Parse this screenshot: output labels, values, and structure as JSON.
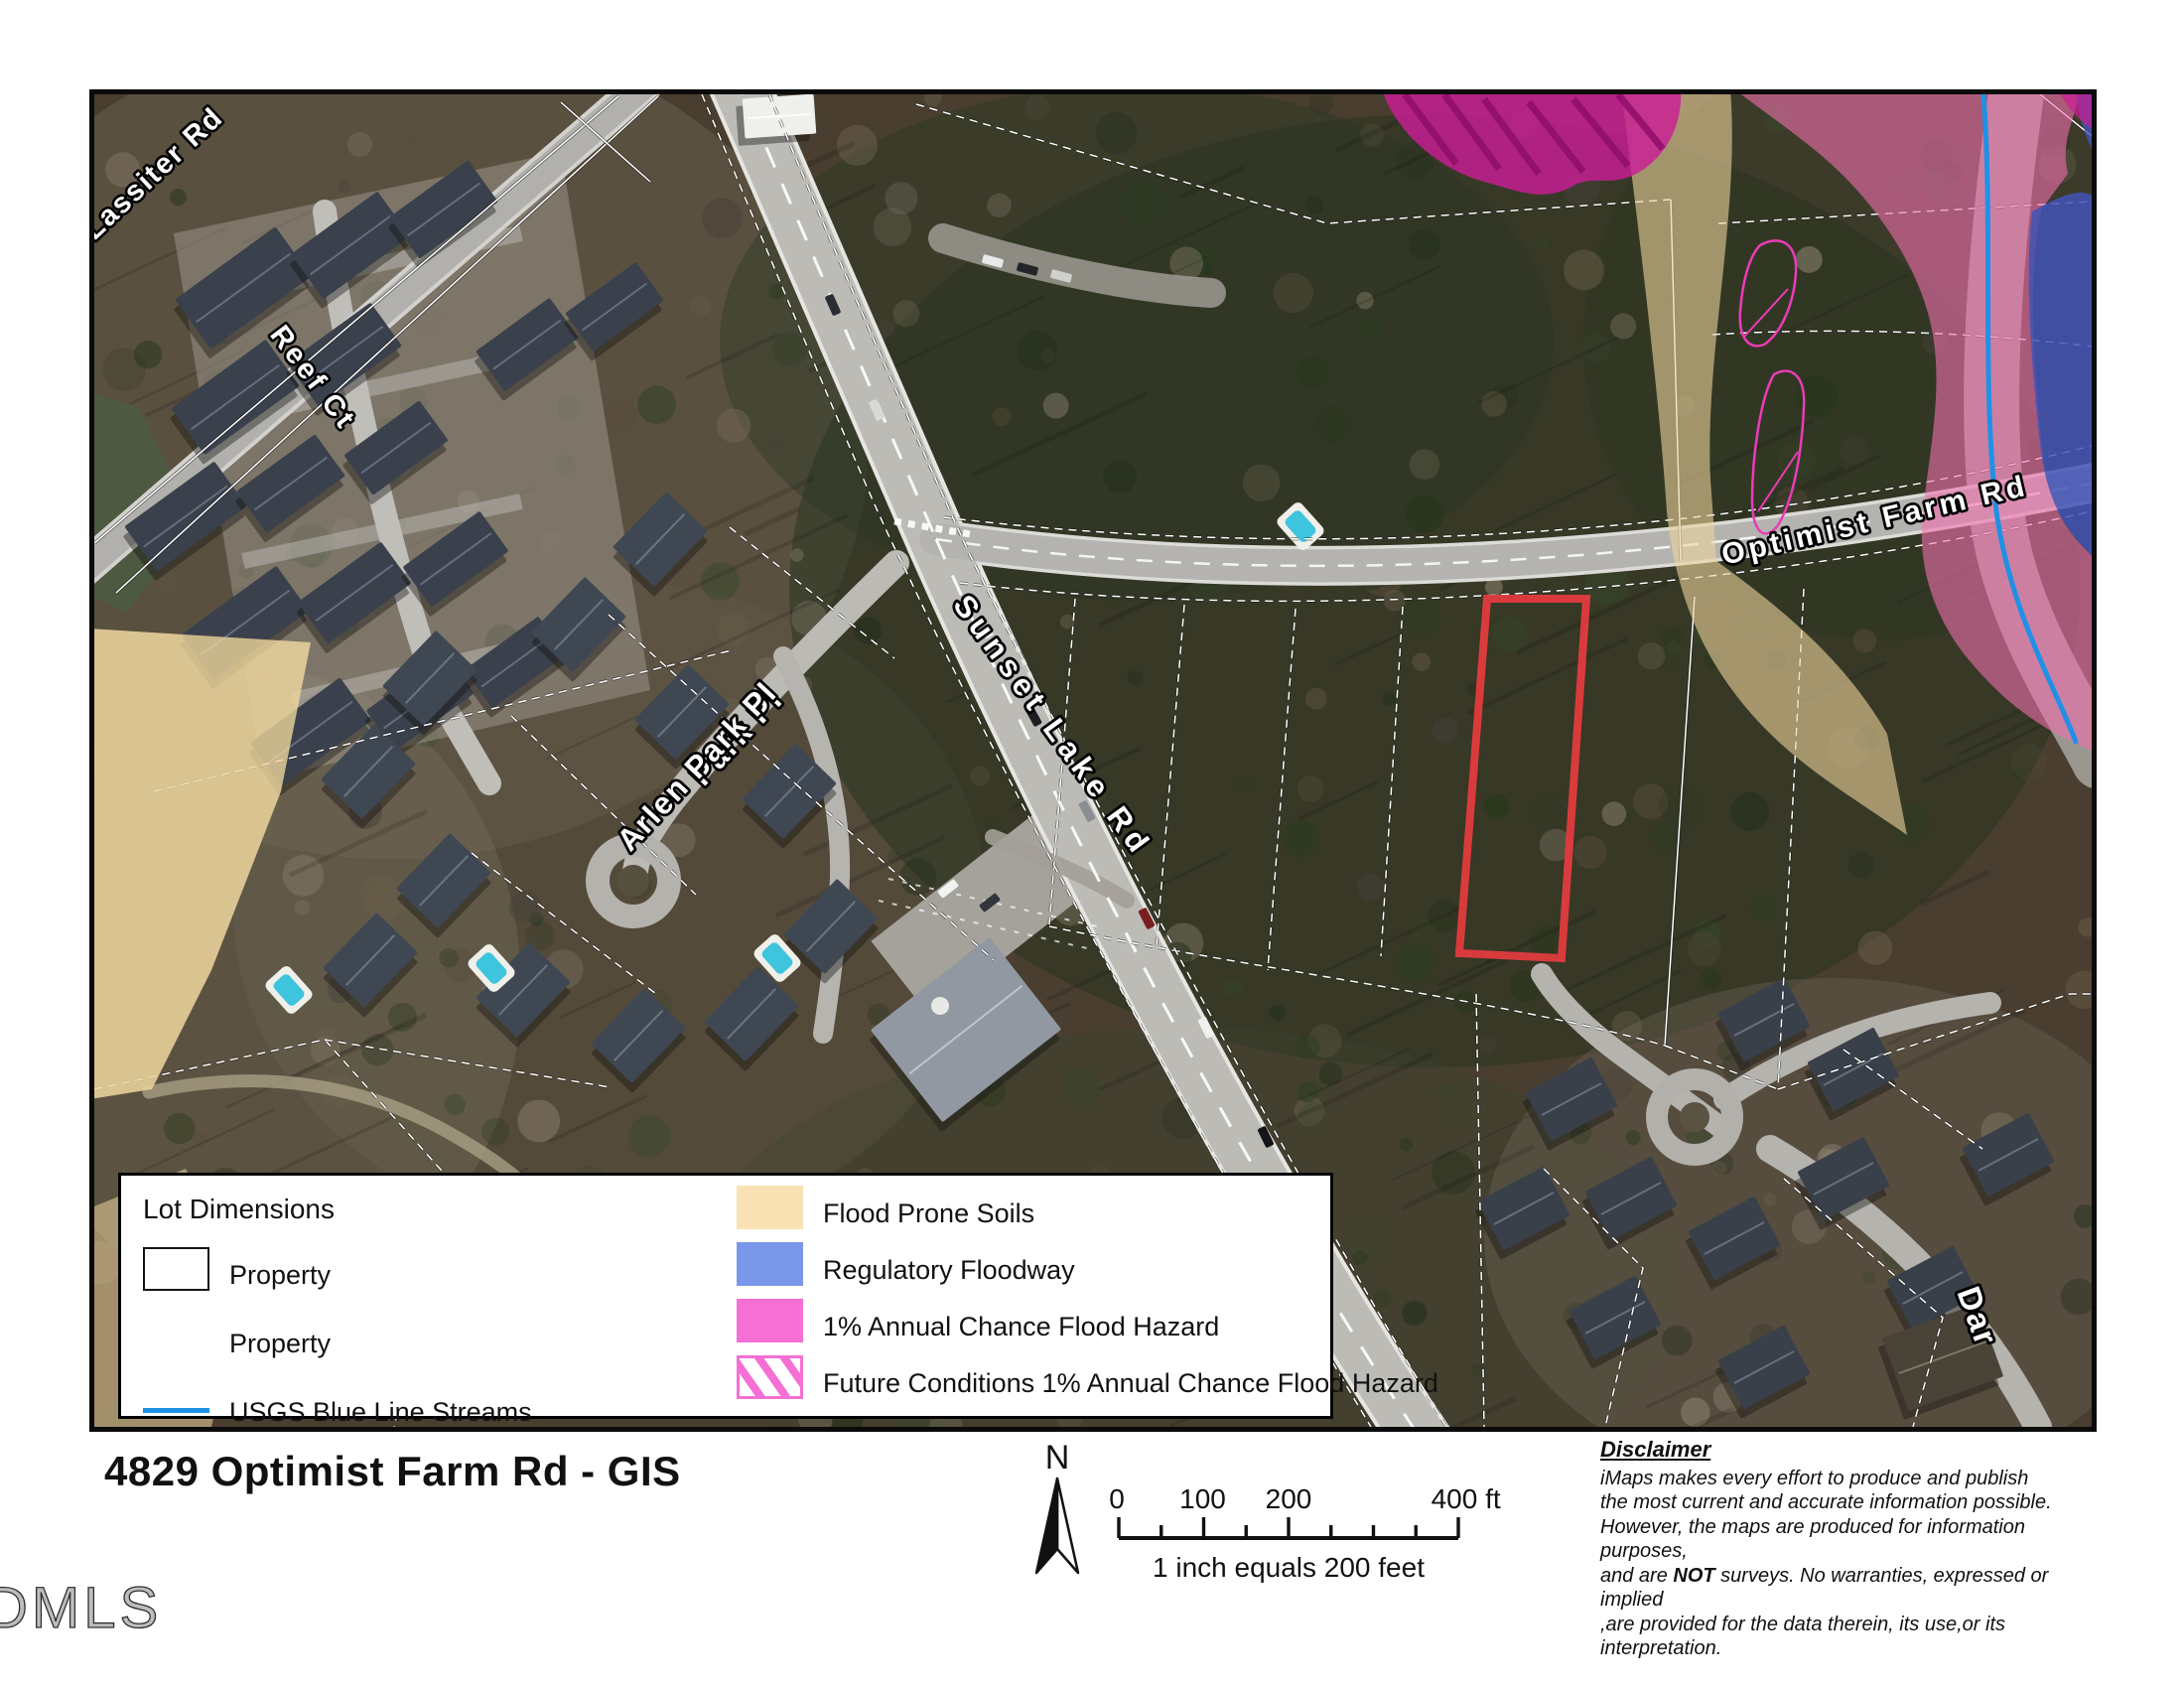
{
  "map": {
    "road_labels": [
      "Lassiter Rd",
      "Reef Ct",
      "Park Pl",
      "Arlen Park Pl",
      "Sunset Lake Rd",
      "Optimist Farm Rd",
      "Dar"
    ],
    "highlight_parcel_color": "#e23b3e",
    "stream_color": "#1f90e6",
    "overlay_colors": {
      "flood_prone_soils": "#edd49c",
      "regulatory_floodway": "#4254b8",
      "annual_chance_flood": "#f06fae",
      "future_conditions": "#cb1d96",
      "future_conditions_outline": "#ea3cb8"
    }
  },
  "legend": {
    "title": "Lot Dimensions",
    "left": [
      {
        "type": "outline",
        "label": "Property"
      },
      {
        "type": "none",
        "label": "Property"
      },
      {
        "type": "line",
        "label": "USGS Blue Line Streams",
        "color": "#1f90e6"
      }
    ],
    "right": [
      {
        "type": "fill",
        "label": "Flood Prone Soils",
        "color": "#f8e2b4"
      },
      {
        "type": "fill",
        "label": "Regulatory Floodway",
        "color": "#7b97ea"
      },
      {
        "type": "fill",
        "label": "1% Annual Chance Flood Hazard",
        "color": "#f56fd4"
      },
      {
        "type": "hatch",
        "label": "Future Conditions 1% Annual Chance Flood Hazard",
        "color": "#f56fd4"
      }
    ]
  },
  "footer": {
    "title": "4829 Optimist Farm Rd - GIS",
    "north_label": "N",
    "scale": {
      "labels": [
        "0",
        "100",
        "200",
        "400 ft"
      ],
      "caption": "1 inch equals 200 feet"
    },
    "disclaimer": {
      "heading": "Disclaimer",
      "lines": [
        "iMaps makes every effort to produce and publish",
        "the most current and accurate information possible.",
        "However, the maps are produced for information purposes,",
        "and are |NOT| surveys. No warranties, expressed or implied",
        ",are provided for the data therein, its use,or its interpretation."
      ]
    },
    "watermark": "DMLS"
  }
}
